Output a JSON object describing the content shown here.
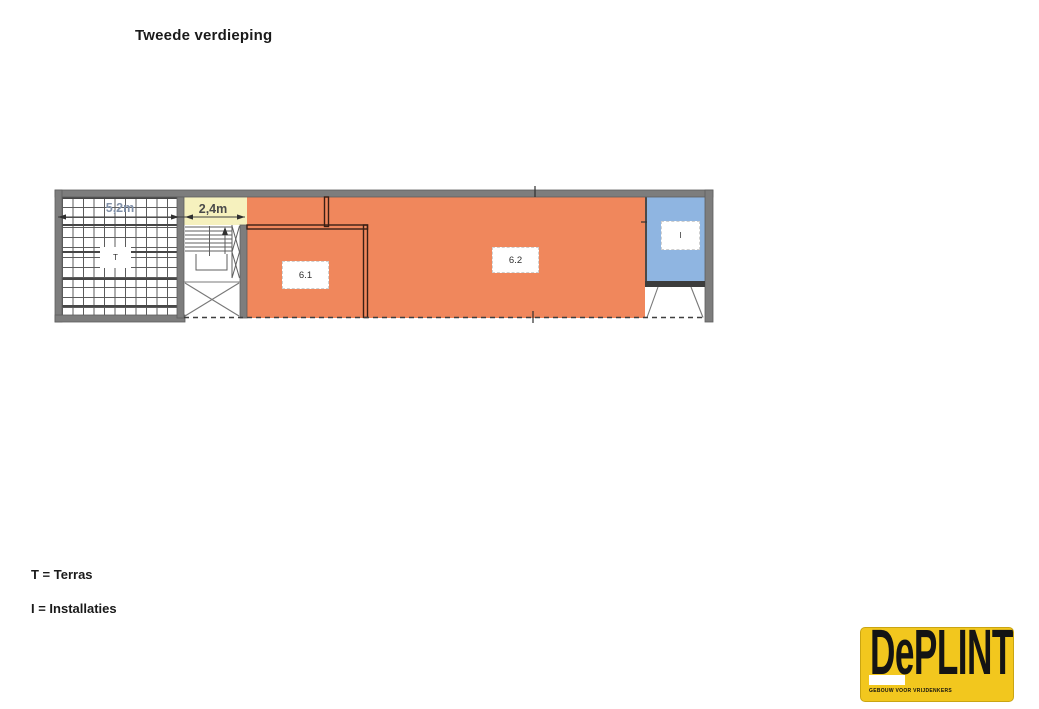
{
  "title": "Tweede verdieping",
  "plan": {
    "dim_terrace": "5,2m",
    "dim_stairwell": "2,4m",
    "label_terrace": "T",
    "label_unit1": "6.1",
    "label_unit2": "6.2",
    "label_installations": "I",
    "colors": {
      "orange": "#F0875C",
      "yellow": "#F6F1BE",
      "blue": "#8FB5E1",
      "wall": "#7D7D7D",
      "dark_wall": "#3A1F14"
    }
  },
  "legend": {
    "terras": "T = Terras",
    "installaties": "I = Installaties"
  },
  "logo": {
    "word_de": "De",
    "word_plint": "PLINT",
    "tagline": "GEBOUW VOOR VRIJDENKERS",
    "bg": "#F2C71E"
  }
}
